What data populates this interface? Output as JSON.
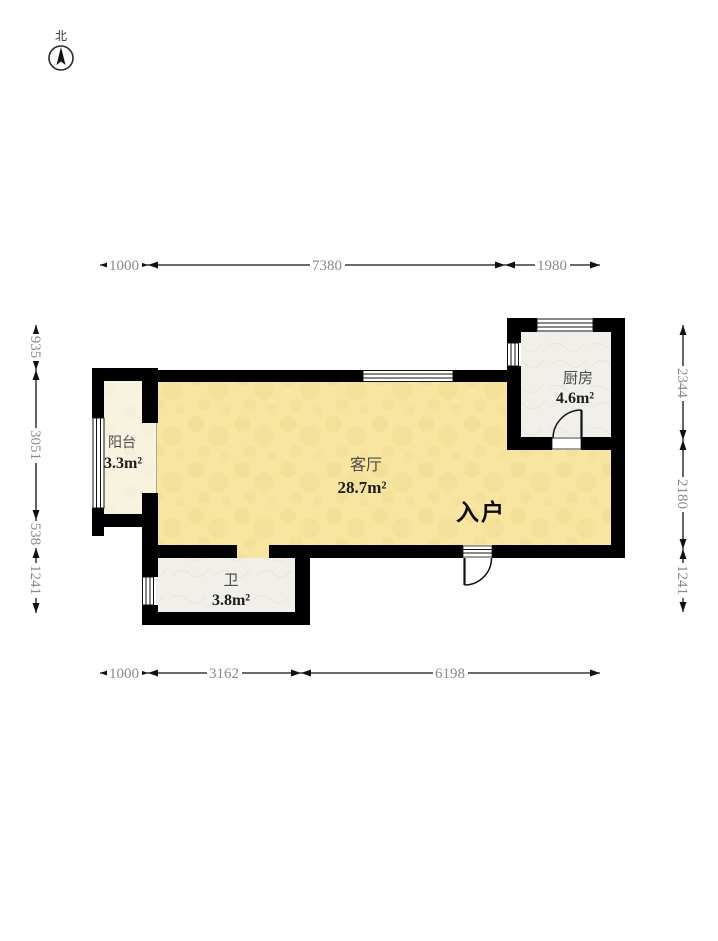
{
  "compass": {
    "north": "北"
  },
  "rooms": {
    "balcony": {
      "name": "阳台",
      "area": "3.3m²"
    },
    "living": {
      "name": "客厅",
      "area": "28.7m²"
    },
    "kitchen": {
      "name": "厨房",
      "area": "4.6m²"
    },
    "bathroom": {
      "name": "卫",
      "area": "3.8m²"
    }
  },
  "entrance": {
    "label": "入户"
  },
  "dimensions": {
    "top": [
      "1000",
      "7380",
      "1980"
    ],
    "bottom": [
      "1000",
      "3162",
      "6198"
    ],
    "left": [
      "935",
      "3051",
      "538",
      "1241"
    ],
    "right": [
      "2344",
      "2180",
      "1241"
    ]
  },
  "colors": {
    "wall": "#000000",
    "living_floor": "#f7e5a0",
    "living_floor_texture": "#f1da8b",
    "balcony_floor": "#f8f3df",
    "balcony_floor_texture": "#efe8cd",
    "tile_floor": "#f0efea",
    "tile_floor_texture": "#e3e1d7",
    "dim_line": "#111111",
    "dim_text": "#8a8a8a",
    "room_text": "#4a4a4a",
    "area_text": "#1d1d1d",
    "entrance_text": "#0c0c0c"
  }
}
